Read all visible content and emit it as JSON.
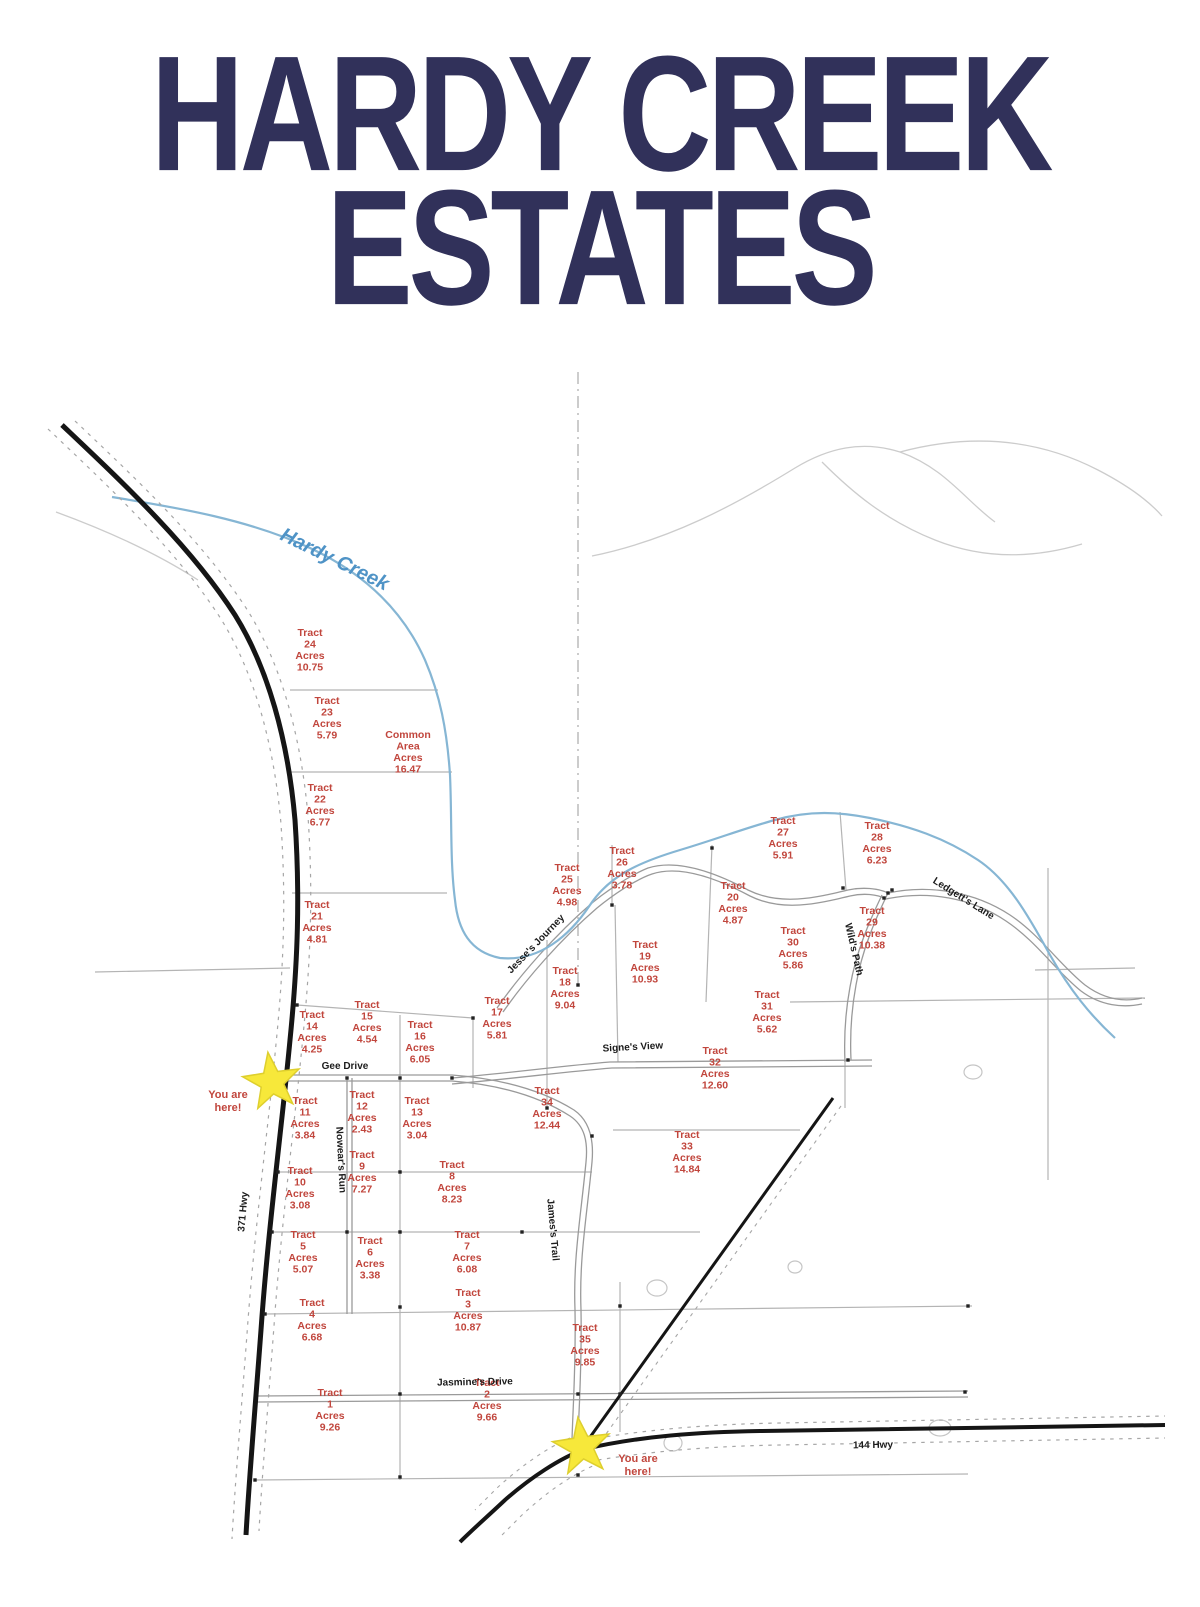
{
  "title": {
    "line1": "HARDY CREEK",
    "line2": "ESTATES"
  },
  "map": {
    "creek_label": "Hardy Creek",
    "words": {
      "tract": "Tract",
      "acres": "Acres"
    },
    "you_are_here": {
      "line1": "You are",
      "line2": "here!"
    },
    "colors": {
      "title": "#31315a",
      "tract_label": "#c1463d",
      "creek": "#86b6d4",
      "creek_label": "#4f93c6",
      "star_fill": "#f7e83a",
      "star_stroke": "#decf2e",
      "black_road": "#151515",
      "gray_road": "#9a9a9a",
      "parcel_line": "#b4b4b4"
    },
    "tracts": [
      {
        "id": "1",
        "acres": "9.26",
        "x": 330,
        "y": 1396
      },
      {
        "id": "2",
        "acres": "9.66",
        "x": 487,
        "y": 1386
      },
      {
        "id": "3",
        "acres": "10.87",
        "x": 468,
        "y": 1296
      },
      {
        "id": "4",
        "acres": "6.68",
        "x": 312,
        "y": 1306
      },
      {
        "id": "5",
        "acres": "5.07",
        "x": 303,
        "y": 1238
      },
      {
        "id": "6",
        "acres": "3.38",
        "x": 370,
        "y": 1244
      },
      {
        "id": "7",
        "acres": "6.08",
        "x": 467,
        "y": 1238
      },
      {
        "id": "8",
        "acres": "8.23",
        "x": 452,
        "y": 1168
      },
      {
        "id": "9",
        "acres": "7.27",
        "x": 362,
        "y": 1158
      },
      {
        "id": "10",
        "acres": "3.08",
        "x": 300,
        "y": 1174
      },
      {
        "id": "11",
        "acres": "3.84",
        "x": 305,
        "y": 1104
      },
      {
        "id": "12",
        "acres": "2.43",
        "x": 362,
        "y": 1098
      },
      {
        "id": "13",
        "acres": "3.04",
        "x": 417,
        "y": 1104
      },
      {
        "id": "14",
        "acres": "4.25",
        "x": 312,
        "y": 1018
      },
      {
        "id": "15",
        "acres": "4.54",
        "x": 367,
        "y": 1008
      },
      {
        "id": "16",
        "acres": "6.05",
        "x": 420,
        "y": 1028
      },
      {
        "id": "17",
        "acres": "5.81",
        "x": 497,
        "y": 1004
      },
      {
        "id": "18",
        "acres": "9.04",
        "x": 565,
        "y": 974
      },
      {
        "id": "19",
        "acres": "10.93",
        "x": 645,
        "y": 948
      },
      {
        "id": "20",
        "acres": "4.87",
        "x": 733,
        "y": 889
      },
      {
        "id": "21",
        "acres": "4.81",
        "x": 317,
        "y": 908
      },
      {
        "id": "22",
        "acres": "6.77",
        "x": 320,
        "y": 791
      },
      {
        "id": "23",
        "acres": "5.79",
        "x": 327,
        "y": 704
      },
      {
        "id": "24",
        "acres": "10.75",
        "x": 310,
        "y": 636
      },
      {
        "id": "25",
        "acres": "4.98",
        "x": 567,
        "y": 871
      },
      {
        "id": "26",
        "acres": "3.78",
        "x": 622,
        "y": 854
      },
      {
        "id": "27",
        "acres": "5.91",
        "x": 783,
        "y": 824
      },
      {
        "id": "28",
        "acres": "6.23",
        "x": 877,
        "y": 829
      },
      {
        "id": "29",
        "acres": "10.38",
        "x": 872,
        "y": 914
      },
      {
        "id": "30",
        "acres": "5.86",
        "x": 793,
        "y": 934
      },
      {
        "id": "31",
        "acres": "5.62",
        "x": 767,
        "y": 998
      },
      {
        "id": "32",
        "acres": "12.60",
        "x": 715,
        "y": 1054
      },
      {
        "id": "33",
        "acres": "14.84",
        "x": 687,
        "y": 1138
      },
      {
        "id": "34",
        "acres": "12.44",
        "x": 547,
        "y": 1094
      },
      {
        "id": "35",
        "acres": "9.85",
        "x": 585,
        "y": 1331
      }
    ],
    "common_area": {
      "lines": [
        "Common",
        "Area",
        "Acres",
        "16.47"
      ],
      "x": 408,
      "y": 738
    },
    "roads": [
      {
        "name": "371 Hwy",
        "x": 246,
        "y": 1212,
        "rot": -85
      },
      {
        "name": "144 Hwy",
        "x": 873,
        "y": 1448,
        "rot": -1
      },
      {
        "name": "Gee Drive",
        "x": 345,
        "y": 1069,
        "rot": 0
      },
      {
        "name": "Jasmine's Drive",
        "x": 475,
        "y": 1385,
        "rot": -1
      },
      {
        "name": "Jesse's Journey",
        "x": 538,
        "y": 946,
        "rot": -46
      },
      {
        "name": "Signe's View",
        "x": 633,
        "y": 1050,
        "rot": -3
      },
      {
        "name": "Ledgett's Lane",
        "x": 962,
        "y": 901,
        "rot": 32
      },
      {
        "name": "Wild's Path",
        "x": 851,
        "y": 950,
        "rot": 77
      },
      {
        "name": "James's Trail",
        "x": 550,
        "y": 1230,
        "rot": 85
      },
      {
        "name": "Nowear's Run",
        "x": 338,
        "y": 1160,
        "rot": 87
      }
    ],
    "stars": [
      {
        "cx": 272,
        "cy": 1082
      },
      {
        "cx": 582,
        "cy": 1447
      }
    ],
    "you_are_here_positions": [
      {
        "x": 228,
        "y": 1098
      },
      {
        "x": 638,
        "y": 1462
      }
    ],
    "creek_label_pos": {
      "x": 332,
      "y": 565,
      "rot": 26
    }
  }
}
